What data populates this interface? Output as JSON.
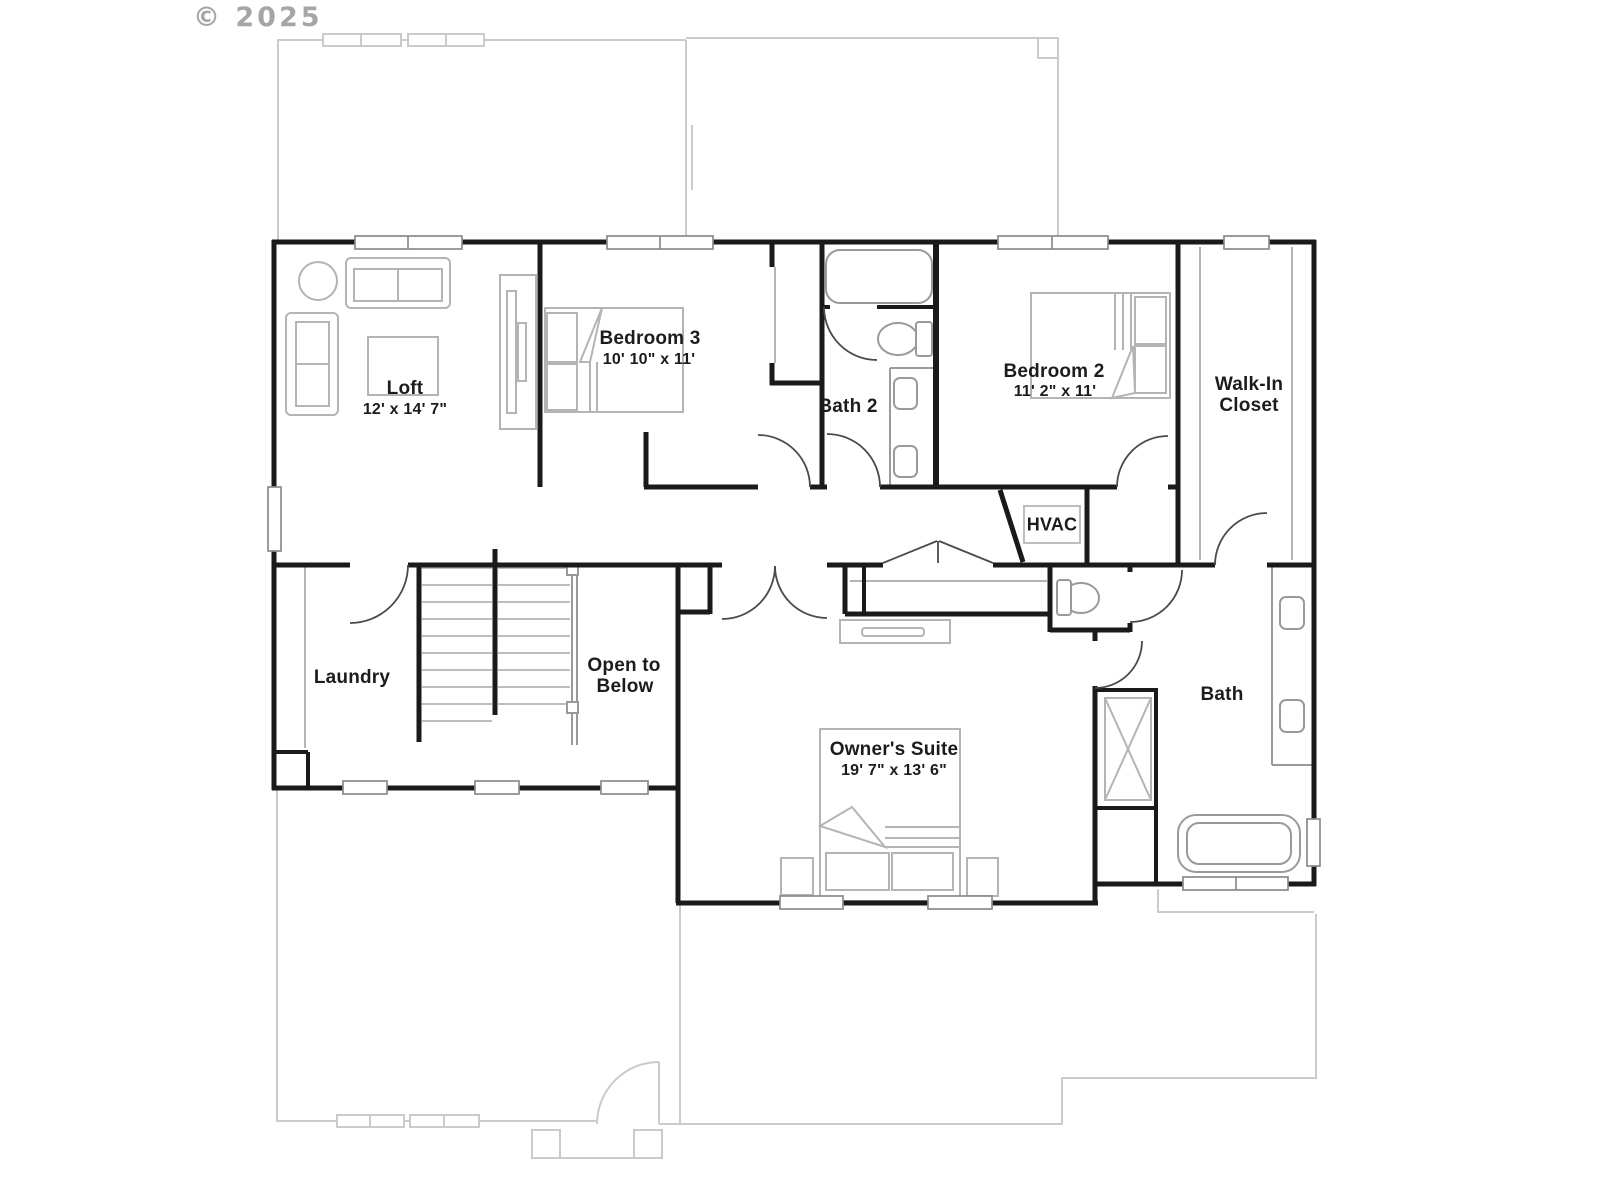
{
  "watermark": "© 2025",
  "colors": {
    "wall": "#1a1a1a",
    "ghost": "#cbcbcb",
    "furniture": "#b4b4b4",
    "fixture": "#9a9a9a",
    "door": "#4a4a4a",
    "tread": "#bdbdbd",
    "label": "#1c1c1c",
    "watermark": "#a6a6a6",
    "background": "#ffffff"
  },
  "rooms": {
    "loft": {
      "name": "Loft",
      "dims": "12' x 14' 7\""
    },
    "bedroom3": {
      "name": "Bedroom 3",
      "dims": "10' 10\" x 11'"
    },
    "bath2": {
      "name": "Bath 2"
    },
    "bedroom2": {
      "name": "Bedroom 2",
      "dims": "11' 2\" x 11'"
    },
    "walk_in_closet": {
      "line1": "Walk-In",
      "line2": "Closet"
    },
    "hvac": {
      "name": "HVAC"
    },
    "laundry": {
      "name": "Laundry"
    },
    "open_to_below": {
      "line1": "Open to",
      "line2": "Below"
    },
    "owners_suite": {
      "name": "Owner's Suite",
      "dims": "19' 7\" x 13' 6\""
    },
    "bath": {
      "name": "Bath"
    }
  }
}
